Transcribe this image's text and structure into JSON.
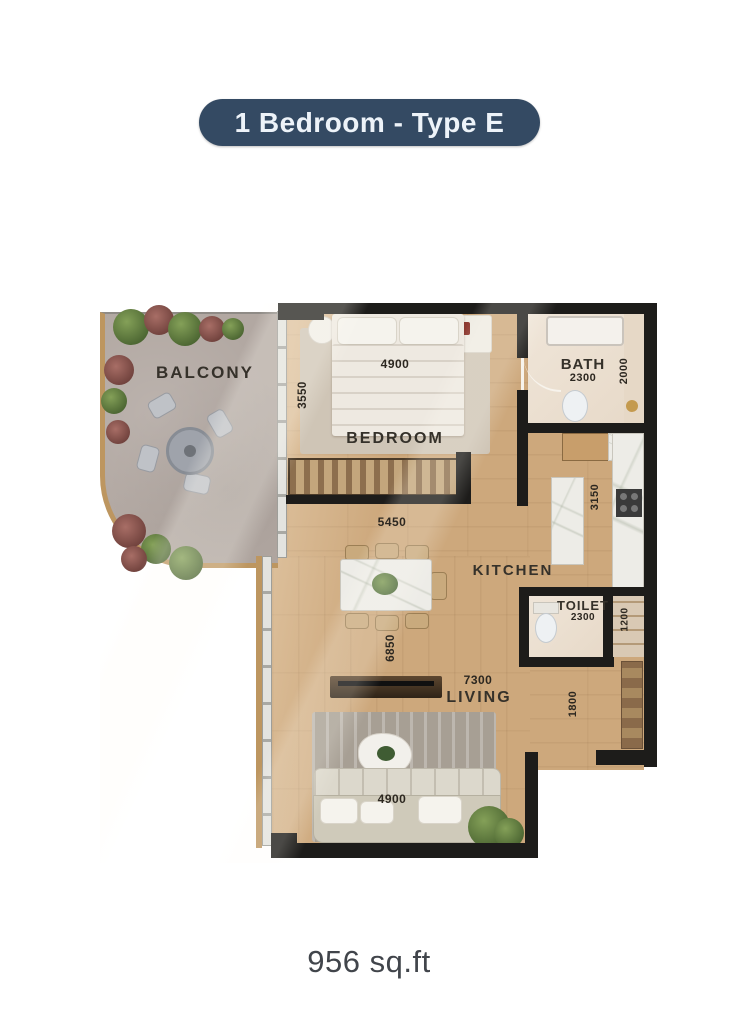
{
  "badge": {
    "title": "1 Bedroom - Type E"
  },
  "footer": {
    "area": "956 sq.ft"
  },
  "rooms": {
    "balcony": {
      "label": "BALCONY"
    },
    "bedroom": {
      "label": "BEDROOM",
      "width": "4900",
      "depth": "3550"
    },
    "bath": {
      "label": "BATH",
      "width": "2300",
      "depth": "2000"
    },
    "kitchen": {
      "label": "KITCHEN",
      "width": "5450",
      "depth": "3150"
    },
    "toilet": {
      "label": "TOILET",
      "width": "2300",
      "depth": "1200"
    },
    "living": {
      "label": "LIVING",
      "width": "7300",
      "depth": "6850",
      "sofa_width": "4900",
      "hall_depth": "1800"
    }
  },
  "colors": {
    "badge_bg": "#344a63",
    "wall": "#1d1c1a",
    "wood_floor": "#cda87c",
    "balcony_floor": "#b2a8a2",
    "gold_trim": "#bd9660",
    "label_text": "#35312a"
  }
}
